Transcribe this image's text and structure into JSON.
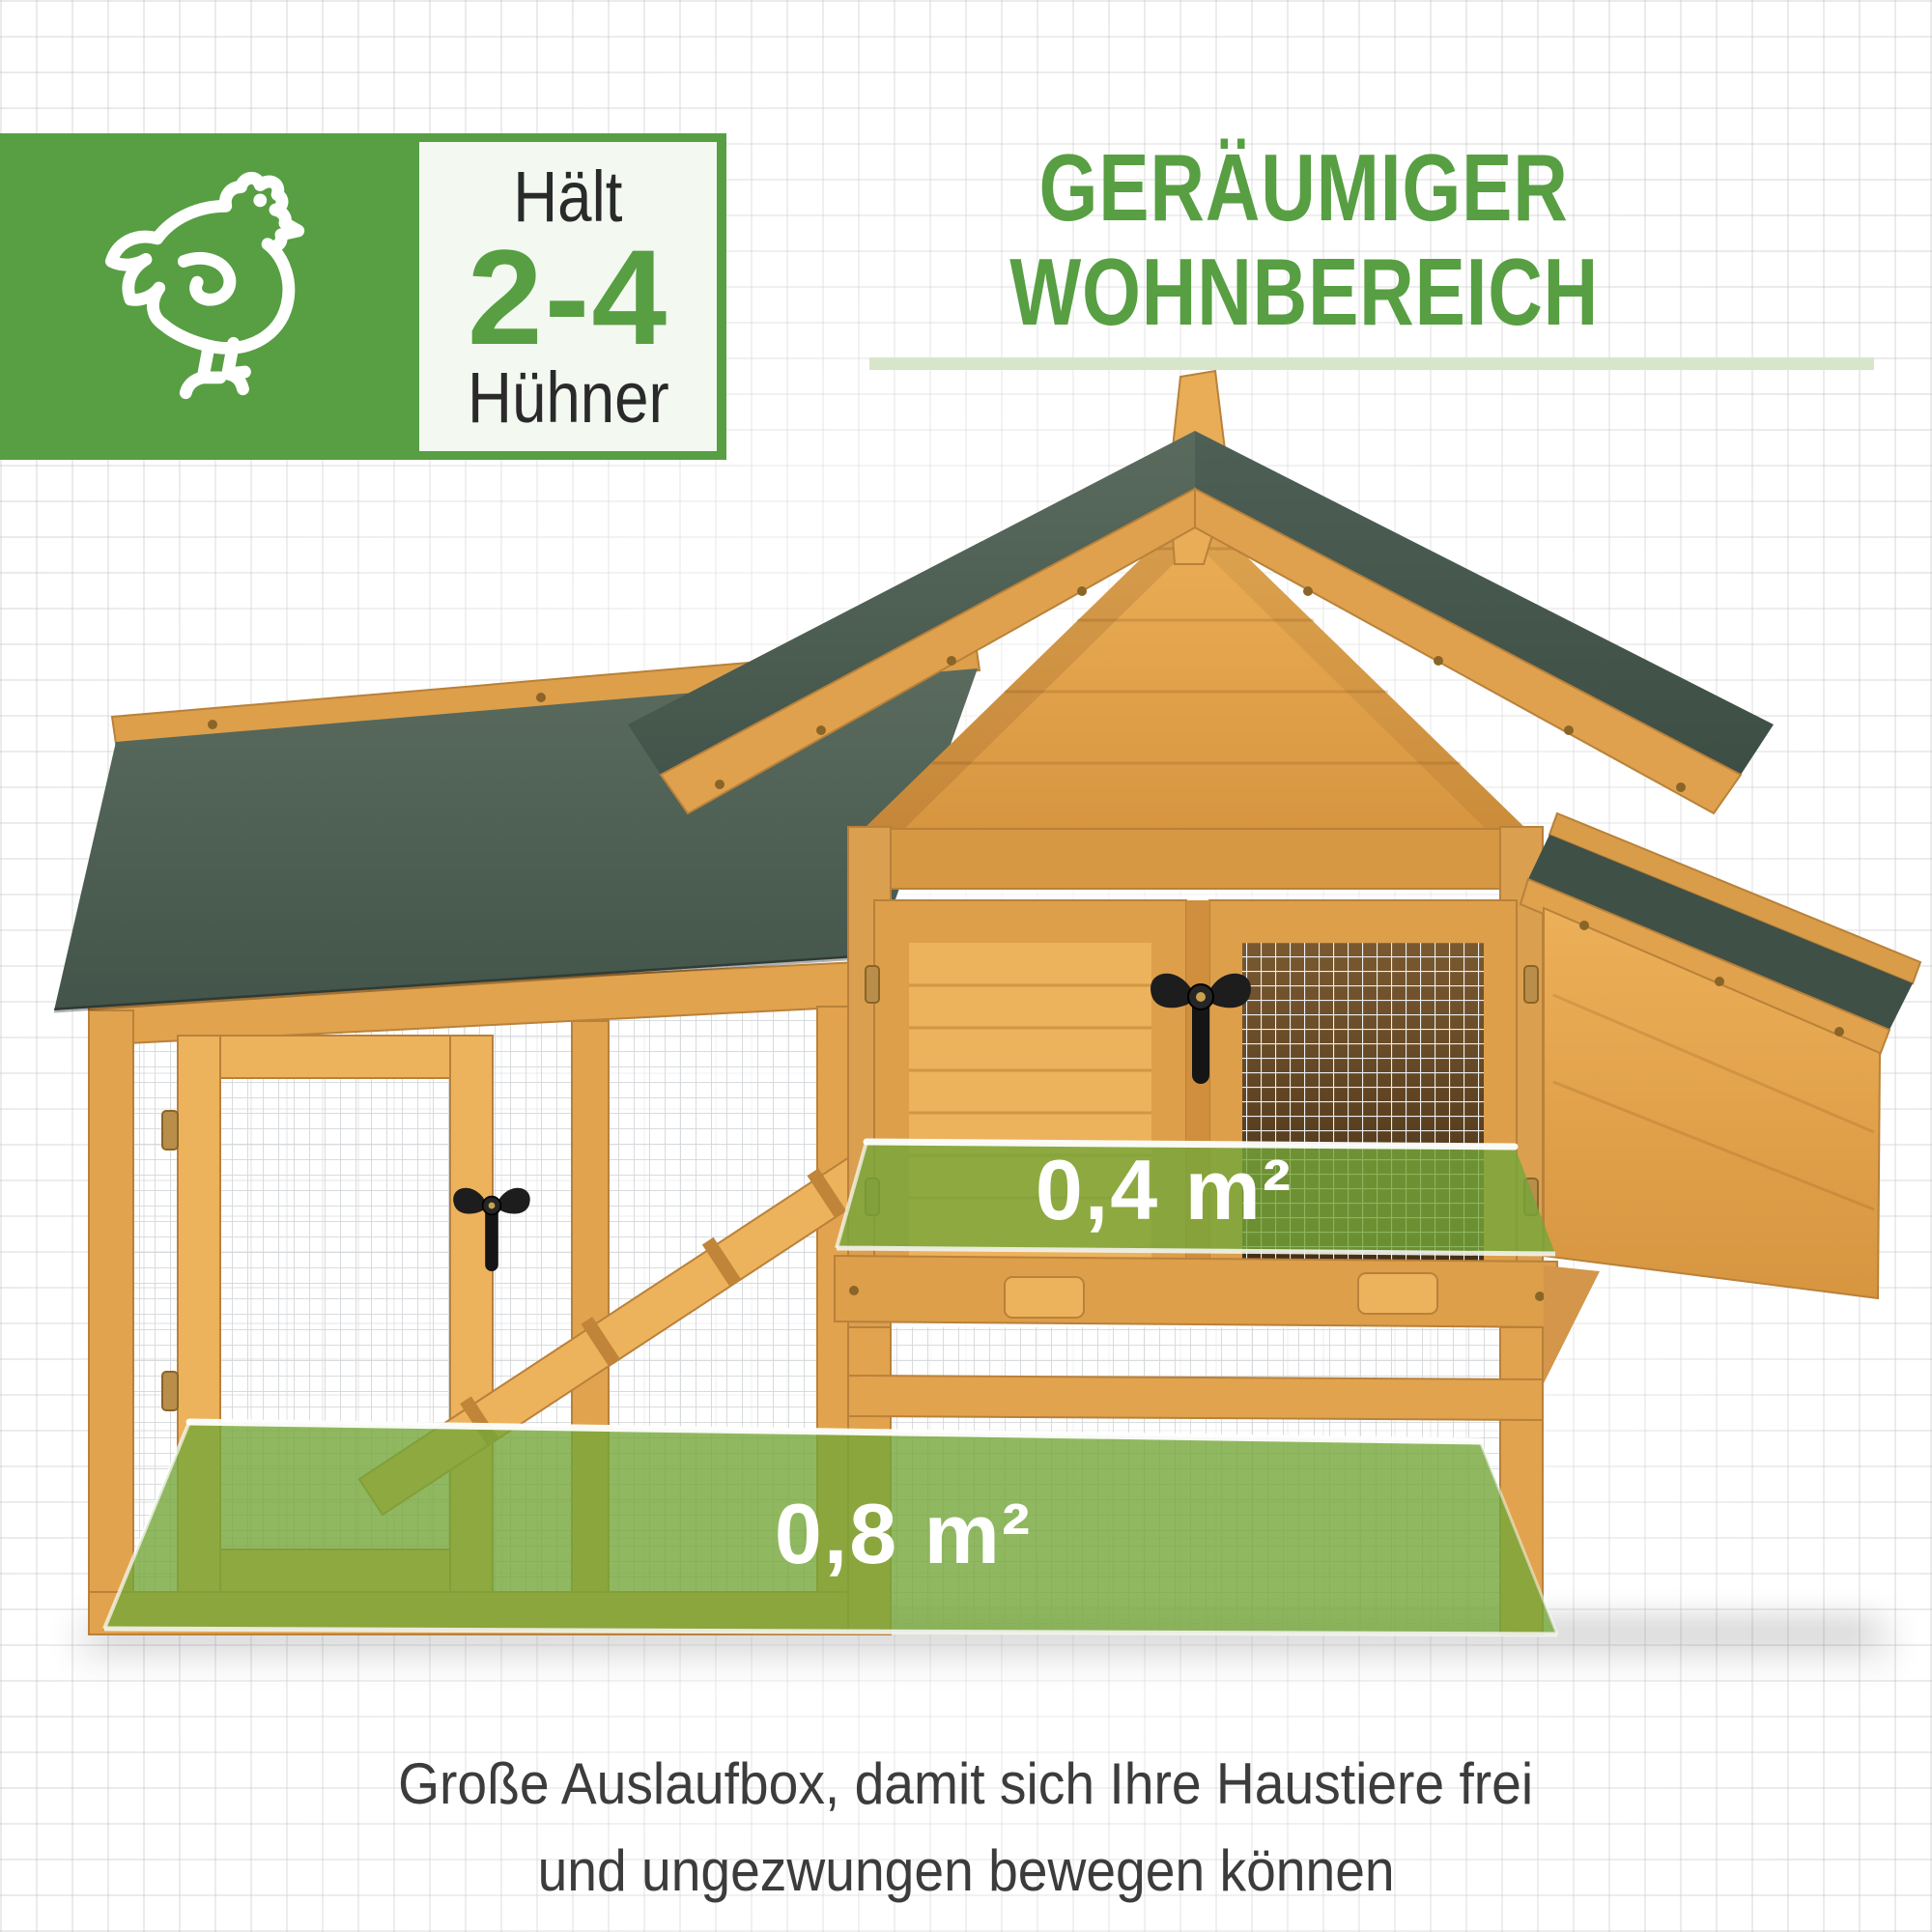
{
  "badge": {
    "icon": "chicken-outline",
    "capacity_label_top": "Hält",
    "capacity_value": "2-4",
    "capacity_label_bottom": "Hühner"
  },
  "heading": {
    "line1": "GERÄUMIGER",
    "line2": "WOHNBEREICH"
  },
  "area_overlays": {
    "house_floor": "0,4 m²",
    "run_floor": "0,8 m²"
  },
  "caption": {
    "line1": "Große Auslaufbox, damit sich Ihre Haustiere frei",
    "line2": "und ungezwungen bewegen können"
  },
  "colors": {
    "brand_green": "#579f42",
    "divider_green": "#d7e6cb",
    "roof_green": "#4c5e53",
    "roof_green_dark": "#3f5047",
    "wood": "#e2a34e",
    "wood_light": "#edb25c",
    "wood_dark": "#c9913f",
    "overlay_green": "#74a63a",
    "interior_brown": "#5d421f",
    "mesh_gray": "#d3d7da",
    "text_dark": "#2a2a2a",
    "caption_gray": "#3c3c3c"
  }
}
